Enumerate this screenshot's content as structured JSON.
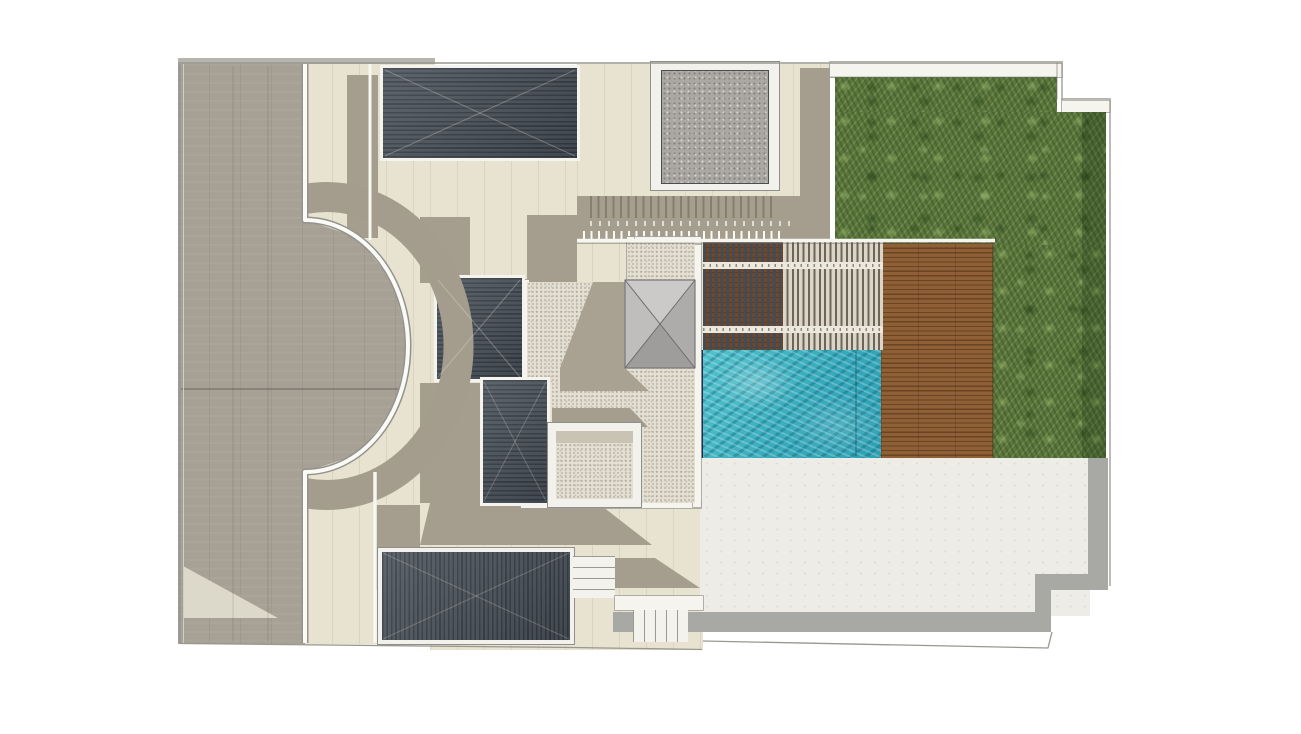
{
  "meta": {
    "canvas": {
      "w": 1301,
      "h": 734
    },
    "background": "#ffffff"
  },
  "palette": {
    "paving_taupe": "#a7a195",
    "paving_cream": "#e7e3d0",
    "shadow": "#a59e8f",
    "roof_slate": "#4b535c",
    "roof_stripe": "#353c44",
    "granite_gray": "#aba8a3",
    "stipple_stone": "#e3dfd3",
    "grass_green": "#5c773d",
    "deck_wood": "#8f5f35",
    "pergola_slat_dark": "#454b52",
    "pergola_slat_light": "#dbd5c8",
    "pool_water": "#3fb4c4",
    "pool_edge_navy": "#232c55",
    "lower_terrace": "#edece6",
    "terrace_border_gray": "#a8a8a4",
    "wall_white": "#f5f4ee",
    "boundary_line": "#98988f"
  },
  "regions": [
    {
      "name": "boundary-wall-cap-top-left",
      "cls": "gray-light",
      "x": 178,
      "y": 58,
      "w": 257,
      "h": 8
    },
    {
      "name": "curved-path-paving",
      "cls": "cream",
      "x": 305,
      "y": 64,
      "w": 130,
      "h": 580
    },
    {
      "name": "central-paving",
      "cls": "cream",
      "x": 430,
      "y": 158,
      "w": 273,
      "h": 492
    },
    {
      "name": "upper-terrace-paving",
      "cls": "cream",
      "x": 577,
      "y": 64,
      "w": 253,
      "h": 178
    },
    {
      "name": "upper-terrace-shadow-band",
      "cls": "shadow",
      "x": 577,
      "y": 196,
      "w": 253,
      "h": 46
    },
    {
      "name": "fence-shadow-comb",
      "cls": "comb",
      "x": 590,
      "y": 196,
      "w": 185,
      "h": 22
    },
    {
      "name": "terrace-dotted-joint-row",
      "cls": "dots",
      "x": 590,
      "y": 221,
      "w": 200,
      "h": 5
    },
    {
      "name": "fence-post-row",
      "cls": "posts",
      "x": 583,
      "y": 231,
      "w": 200,
      "h": 9
    },
    {
      "name": "shadow-col-right-of-patio",
      "cls": "shadow",
      "x": 800,
      "y": 68,
      "w": 30,
      "h": 128
    },
    {
      "name": "patio-frame",
      "cls": "frame",
      "x": 651,
      "y": 62,
      "w": 128,
      "h": 128
    },
    {
      "name": "patio-granite-inner",
      "cls": "granite",
      "x": 661,
      "y": 70,
      "w": 108,
      "h": 114
    },
    {
      "name": "driveway",
      "cls": "taupe",
      "x": 178,
      "y": 64,
      "w": 230,
      "h": 580,
      "clip": [
        [
          0,
          0
        ],
        [
          127,
          0
        ],
        [
          127,
          156
        ],
        [
          179,
          173
        ],
        [
          216,
          219
        ],
        [
          230,
          282
        ],
        [
          216,
          345
        ],
        [
          179,
          391
        ],
        [
          127,
          408
        ],
        [
          127,
          580
        ],
        [
          0,
          580
        ]
      ]
    },
    {
      "name": "driveway-light-wedge",
      "cls": "cream-light",
      "x": 183,
      "y": 560,
      "w": 95,
      "h": 60,
      "clip": [
        [
          0,
          6
        ],
        [
          95,
          58
        ],
        [
          0,
          58
        ]
      ]
    },
    {
      "name": "path-shadow-stripe-top",
      "cls": "shadow",
      "x": 347,
      "y": 75,
      "w": 31,
      "h": 163
    },
    {
      "name": "shadow-above-roof2",
      "cls": "shadow",
      "x": 420,
      "y": 217,
      "w": 50,
      "h": 66
    },
    {
      "name": "shadow-courtyard-top-left",
      "cls": "shadow",
      "x": 527,
      "y": 215,
      "w": 50,
      "h": 72
    },
    {
      "name": "roof-1-main",
      "cls": "roof-h edge",
      "x": 383,
      "y": 68,
      "w": 194,
      "h": 90
    },
    {
      "name": "garden-boundary-wall-top",
      "cls": "wall",
      "x": 830,
      "y": 62,
      "w": 232,
      "h": 15
    },
    {
      "name": "garden-boundary-wall-notch",
      "cls": "wall",
      "x": 1062,
      "y": 99,
      "w": 48,
      "h": 13
    },
    {
      "name": "garden-upper-band",
      "cls": "grass",
      "x": 835,
      "y": 77,
      "w": 222,
      "h": 35
    },
    {
      "name": "garden-main",
      "cls": "grass",
      "x": 835,
      "y": 112,
      "w": 271,
      "h": 133
    },
    {
      "name": "garden-right-column",
      "cls": "grass",
      "x": 993,
      "y": 245,
      "w": 113,
      "h": 213
    },
    {
      "name": "garden-dark-edge",
      "cls": "grass-dark",
      "x": 1082,
      "y": 112,
      "w": 24,
      "h": 346
    },
    {
      "name": "wood-deck",
      "cls": "wood",
      "x": 881,
      "y": 243,
      "w": 112,
      "h": 215
    },
    {
      "name": "pergola-dark-slats",
      "cls": "pergola-dark",
      "x": 703,
      "y": 242,
      "w": 80,
      "h": 108
    },
    {
      "name": "pergola-light-slats",
      "cls": "pergola-light",
      "x": 783,
      "y": 242,
      "w": 100,
      "h": 108
    },
    {
      "name": "pergola-beam-upper",
      "cls": "beam",
      "x": 703,
      "y": 262,
      "w": 180,
      "h": 7
    },
    {
      "name": "pergola-beam-lower",
      "cls": "beam",
      "x": 703,
      "y": 326,
      "w": 180,
      "h": 7
    },
    {
      "name": "pool-edge-coping",
      "cls": "navy",
      "x": 696,
      "y": 350,
      "w": 7,
      "h": 108
    },
    {
      "name": "swimming-pool",
      "cls": "water",
      "x": 703,
      "y": 350,
      "w": 178,
      "h": 108
    },
    {
      "name": "lower-terrace",
      "cls": "terrace",
      "x": 700,
      "y": 458,
      "w": 390,
      "h": 158
    },
    {
      "name": "terrace-border-right",
      "cls": "gray-band",
      "x": 1088,
      "y": 458,
      "w": 20,
      "h": 118
    },
    {
      "name": "terrace-border-step-1",
      "cls": "gray-band",
      "x": 1035,
      "y": 574,
      "w": 73,
      "h": 16
    },
    {
      "name": "terrace-border-step-2",
      "cls": "gray-band",
      "x": 1035,
      "y": 588,
      "w": 16,
      "h": 26
    },
    {
      "name": "terrace-border-bottom",
      "cls": "gray-band",
      "x": 613,
      "y": 612,
      "w": 438,
      "h": 20
    },
    {
      "name": "shadow-bottom-path",
      "cls": "shadow",
      "x": 375,
      "y": 505,
      "w": 45,
      "h": 85
    },
    {
      "name": "shadow-below-courtyard",
      "cls": "shadow",
      "x": 420,
      "y": 495,
      "w": 235,
      "h": 50,
      "clip": [
        [
          10,
          8
        ],
        [
          178,
          8
        ],
        [
          232,
          50
        ],
        [
          0,
          50
        ]
      ]
    },
    {
      "name": "shadow-by-stairs",
      "cls": "shadow",
      "x": 575,
      "y": 558,
      "w": 128,
      "h": 32,
      "clip": [
        [
          0,
          0
        ],
        [
          80,
          0
        ],
        [
          125,
          30
        ],
        [
          0,
          30
        ]
      ]
    },
    {
      "name": "courtyard-wall-left",
      "cls": "wall",
      "x": 521,
      "y": 280,
      "w": 8,
      "h": 227
    },
    {
      "name": "courtyard-wall-bottom",
      "cls": "wall",
      "x": 521,
      "y": 501,
      "w": 180,
      "h": 7
    },
    {
      "name": "courtyard-wall-right",
      "cls": "wall",
      "x": 693,
      "y": 237,
      "w": 8,
      "h": 270
    },
    {
      "name": "courtyard-wall-top",
      "cls": "wall",
      "x": 627,
      "y": 237,
      "w": 74,
      "h": 7
    },
    {
      "name": "courtyard-wall-mid",
      "cls": "wall",
      "x": 627,
      "y": 237,
      "w": 7,
      "h": 47
    },
    {
      "name": "courtyard-gravel",
      "cls": "stipple",
      "x": 527,
      "y": 242,
      "w": 168,
      "h": 261,
      "clip": [
        [
          0,
          40
        ],
        [
          100,
          40
        ],
        [
          100,
          0
        ],
        [
          168,
          0
        ],
        [
          168,
          261
        ],
        [
          25,
          261
        ],
        [
          25,
          140
        ],
        [
          0,
          140
        ]
      ]
    },
    {
      "name": "small-court-shadow",
      "cls": "shadow",
      "x": 552,
      "y": 405,
      "w": 98,
      "h": 24,
      "clip": [
        [
          0,
          3
        ],
        [
          78,
          3
        ],
        [
          96,
          22
        ],
        [
          0,
          22
        ]
      ]
    },
    {
      "name": "roof-2",
      "cls": "roof-h edge",
      "x": 437,
      "y": 278,
      "w": 85,
      "h": 101
    },
    {
      "name": "shadow-left-of-roof3",
      "cls": "shadow",
      "x": 420,
      "y": 383,
      "w": 63,
      "h": 120
    },
    {
      "name": "roof-3",
      "cls": "roof-h edge",
      "x": 483,
      "y": 380,
      "w": 64,
      "h": 123
    },
    {
      "name": "small-court-frame",
      "cls": "frame",
      "x": 548,
      "y": 423,
      "w": 93,
      "h": 84
    },
    {
      "name": "small-court-gravel",
      "cls": "stipple",
      "x": 556,
      "y": 431,
      "w": 77,
      "h": 68
    },
    {
      "name": "small-court-inner-shadow",
      "cls": "shadow-light",
      "x": 556,
      "y": 431,
      "w": 77,
      "h": 12
    },
    {
      "name": "roof-4-frame",
      "cls": "frame",
      "x": 378,
      "y": 548,
      "w": 196,
      "h": 96
    },
    {
      "name": "roof-4",
      "cls": "roof-v",
      "x": 382,
      "y": 552,
      "w": 188,
      "h": 88
    },
    {
      "name": "stairs-horizontal",
      "cls": "steps-h",
      "x": 573,
      "y": 556,
      "w": 42,
      "h": 42
    },
    {
      "name": "stairs-landing",
      "cls": "wall",
      "x": 615,
      "y": 596,
      "w": 88,
      "h": 14
    },
    {
      "name": "stairs-vertical",
      "cls": "steps-v",
      "x": 633,
      "y": 610,
      "w": 55,
      "h": 32
    }
  ],
  "svg_shapes": [
    {
      "name": "arc-shadow-band",
      "type": "path",
      "d": "M305,199 A132,149 0 1 1 305,493",
      "stroke": "#a49d8e",
      "width": 30
    },
    {
      "name": "drive-edge-outline",
      "type": "path",
      "d": "M305,64 L305,220 A103,126 0 1 1 305,472 L305,643",
      "stroke": "#93938d",
      "width": 7
    },
    {
      "name": "drive-edge-white",
      "type": "path",
      "d": "M305,64 L305,220 A103,126 0 1 1 305,472 L305,643",
      "stroke": "#fbfaf6",
      "width": 4
    },
    {
      "name": "upper-path-edge",
      "type": "line",
      "x1": 370,
      "y1": 64,
      "x2": 370,
      "y2": 240,
      "stroke": "#f8f7f0",
      "width": 3
    },
    {
      "name": "lower-path-wall",
      "type": "line",
      "x1": 375,
      "y1": 472,
      "x2": 375,
      "y2": 643,
      "stroke": "#f8f7f0",
      "width": 3.5
    },
    {
      "name": "drive-divider-joint",
      "type": "line",
      "x1": 180,
      "y1": 389,
      "x2": 398,
      "y2": 389,
      "stroke": "rgba(70,70,62,0.55)",
      "width": 1.2
    },
    {
      "name": "drive-joint-a",
      "type": "line",
      "x1": 233,
      "y1": 66,
      "x2": 233,
      "y2": 641,
      "stroke": "rgba(60,60,55,0.18)",
      "width": 1
    },
    {
      "name": "drive-joint-b",
      "type": "line",
      "x1": 268,
      "y1": 66,
      "x2": 268,
      "y2": 641,
      "stroke": "rgba(60,60,55,0.18)",
      "width": 1
    },
    {
      "name": "roof1-diag-a",
      "type": "line",
      "x1": 385,
      "y1": 70,
      "x2": 575,
      "y2": 156,
      "stroke": "rgba(235,235,230,0.28)",
      "width": 1.2
    },
    {
      "name": "roof1-diag-b",
      "type": "line",
      "x1": 385,
      "y1": 156,
      "x2": 575,
      "y2": 70,
      "stroke": "rgba(235,235,230,0.28)",
      "width": 1.2
    },
    {
      "name": "roof2-diag-a",
      "type": "line",
      "x1": 438,
      "y1": 280,
      "x2": 520,
      "y2": 377,
      "stroke": "rgba(235,235,230,0.28)",
      "width": 1.2
    },
    {
      "name": "roof2-diag-b",
      "type": "line",
      "x1": 438,
      "y1": 377,
      "x2": 520,
      "y2": 280,
      "stroke": "rgba(235,235,230,0.28)",
      "width": 1.2
    },
    {
      "name": "roof3-diag-a",
      "type": "line",
      "x1": 484,
      "y1": 382,
      "x2": 546,
      "y2": 501,
      "stroke": "rgba(235,235,230,0.22)",
      "width": 1.1
    },
    {
      "name": "roof3-diag-b",
      "type": "line",
      "x1": 484,
      "y1": 501,
      "x2": 546,
      "y2": 382,
      "stroke": "rgba(235,235,230,0.22)",
      "width": 1.1
    },
    {
      "name": "roof4-diag-a",
      "type": "line",
      "x1": 383,
      "y1": 553,
      "x2": 569,
      "y2": 639,
      "stroke": "rgba(235,235,230,0.22)",
      "width": 1.1
    },
    {
      "name": "roof4-diag-b",
      "type": "line",
      "x1": 383,
      "y1": 639,
      "x2": 569,
      "y2": 553,
      "stroke": "rgba(235,235,230,0.22)",
      "width": 1.1
    },
    {
      "name": "deck-top-edge-white",
      "type": "line",
      "x1": 577,
      "y1": 240.5,
      "x2": 995,
      "y2": 240.5,
      "stroke": "#f6f5ef",
      "width": 3.5
    },
    {
      "name": "deck-top-edge-hairline",
      "type": "line",
      "x1": 577,
      "y1": 243.2,
      "x2": 995,
      "y2": 243.2,
      "stroke": "rgba(95,95,88,0.55)",
      "width": 1
    },
    {
      "name": "pavilion-roof-shadow",
      "type": "polygon",
      "points": "593,282 625,282 625,368 649,391 560,391 560,368",
      "fill": "#a9a293"
    },
    {
      "name": "pavilion-roof-face-top",
      "type": "polygon",
      "points": "625,280 695,280 660,324",
      "fill": "#cbcac8"
    },
    {
      "name": "pavilion-roof-face-right",
      "type": "polygon",
      "points": "695,280 695,368 660,324",
      "fill": "#adacaa"
    },
    {
      "name": "pavilion-roof-face-bottom",
      "type": "polygon",
      "points": "625,368 695,368 660,324",
      "fill": "#9e9d9b"
    },
    {
      "name": "pavilion-roof-face-left",
      "type": "polygon",
      "points": "625,280 625,368 660,324",
      "fill": "#bfbebc"
    },
    {
      "name": "pavilion-roof-outline",
      "type": "polygon",
      "points": "625,280 695,280 695,368 625,368",
      "fill": "none",
      "stroke": "#7a7977",
      "width": 1.2
    },
    {
      "name": "pavilion-roof-hip-a",
      "type": "line",
      "x1": 625,
      "y1": 280,
      "x2": 695,
      "y2": 368,
      "stroke": "#6f6e6c",
      "width": 1
    },
    {
      "name": "pavilion-roof-hip-b",
      "type": "line",
      "x1": 695,
      "y1": 280,
      "x2": 625,
      "y2": 368,
      "stroke": "#6f6e6c",
      "width": 1
    },
    {
      "name": "pool-overflow-line",
      "type": "line",
      "x1": 856,
      "y1": 352,
      "x2": 856,
      "y2": 456,
      "stroke": "rgba(15,70,85,0.4)",
      "width": 1.5
    },
    {
      "name": "deck-garden-joint",
      "type": "line",
      "x1": 993,
      "y1": 246,
      "x2": 993,
      "y2": 456,
      "stroke": "rgba(45,60,30,0.45)",
      "width": 1
    },
    {
      "name": "boundary-left",
      "type": "line",
      "x1": 180,
      "y1": 64,
      "x2": 180,
      "y2": 643,
      "stroke": "#98988f",
      "width": 1.6
    },
    {
      "name": "boundary-left-inner",
      "type": "line",
      "x1": 183.5,
      "y1": 64,
      "x2": 183.5,
      "y2": 643,
      "stroke": "#cfcec6",
      "width": 1
    },
    {
      "name": "boundary-top",
      "type": "line",
      "x1": 178,
      "y1": 63,
      "x2": 1062,
      "y2": 63,
      "stroke": "#98988f",
      "width": 1.4
    },
    {
      "name": "boundary-notch-v",
      "type": "line",
      "x1": 1062,
      "y1": 63,
      "x2": 1062,
      "y2": 100,
      "stroke": "#98988f",
      "width": 1.3
    },
    {
      "name": "boundary-notch-h",
      "type": "line",
      "x1": 1062,
      "y1": 100,
      "x2": 1110,
      "y2": 100,
      "stroke": "#98988f",
      "width": 1.3
    },
    {
      "name": "boundary-right",
      "type": "line",
      "x1": 1110,
      "y1": 100,
      "x2": 1110,
      "y2": 586,
      "stroke": "#98988f",
      "width": 1.3
    },
    {
      "name": "garden-top-hairline",
      "type": "line",
      "x1": 830,
      "y1": 77,
      "x2": 1057,
      "y2": 77,
      "stroke": "rgba(110,110,100,0.5)",
      "width": 1
    },
    {
      "name": "notch-inner-hairline",
      "type": "line",
      "x1": 1057,
      "y1": 63,
      "x2": 1057,
      "y2": 99,
      "stroke": "rgba(110,110,100,0.6)",
      "width": 1
    },
    {
      "name": "boundary-bottom-left",
      "type": "path",
      "d": "M180,643.5 L574,647.5 L702,649.5",
      "stroke": "#98988f",
      "width": 1.3,
      "fill": "none"
    },
    {
      "name": "boundary-bottom-right",
      "type": "path",
      "d": "M703,641 L1048,648 L1052,632",
      "stroke": "#98988f",
      "width": 1.3,
      "fill": "none"
    }
  ]
}
